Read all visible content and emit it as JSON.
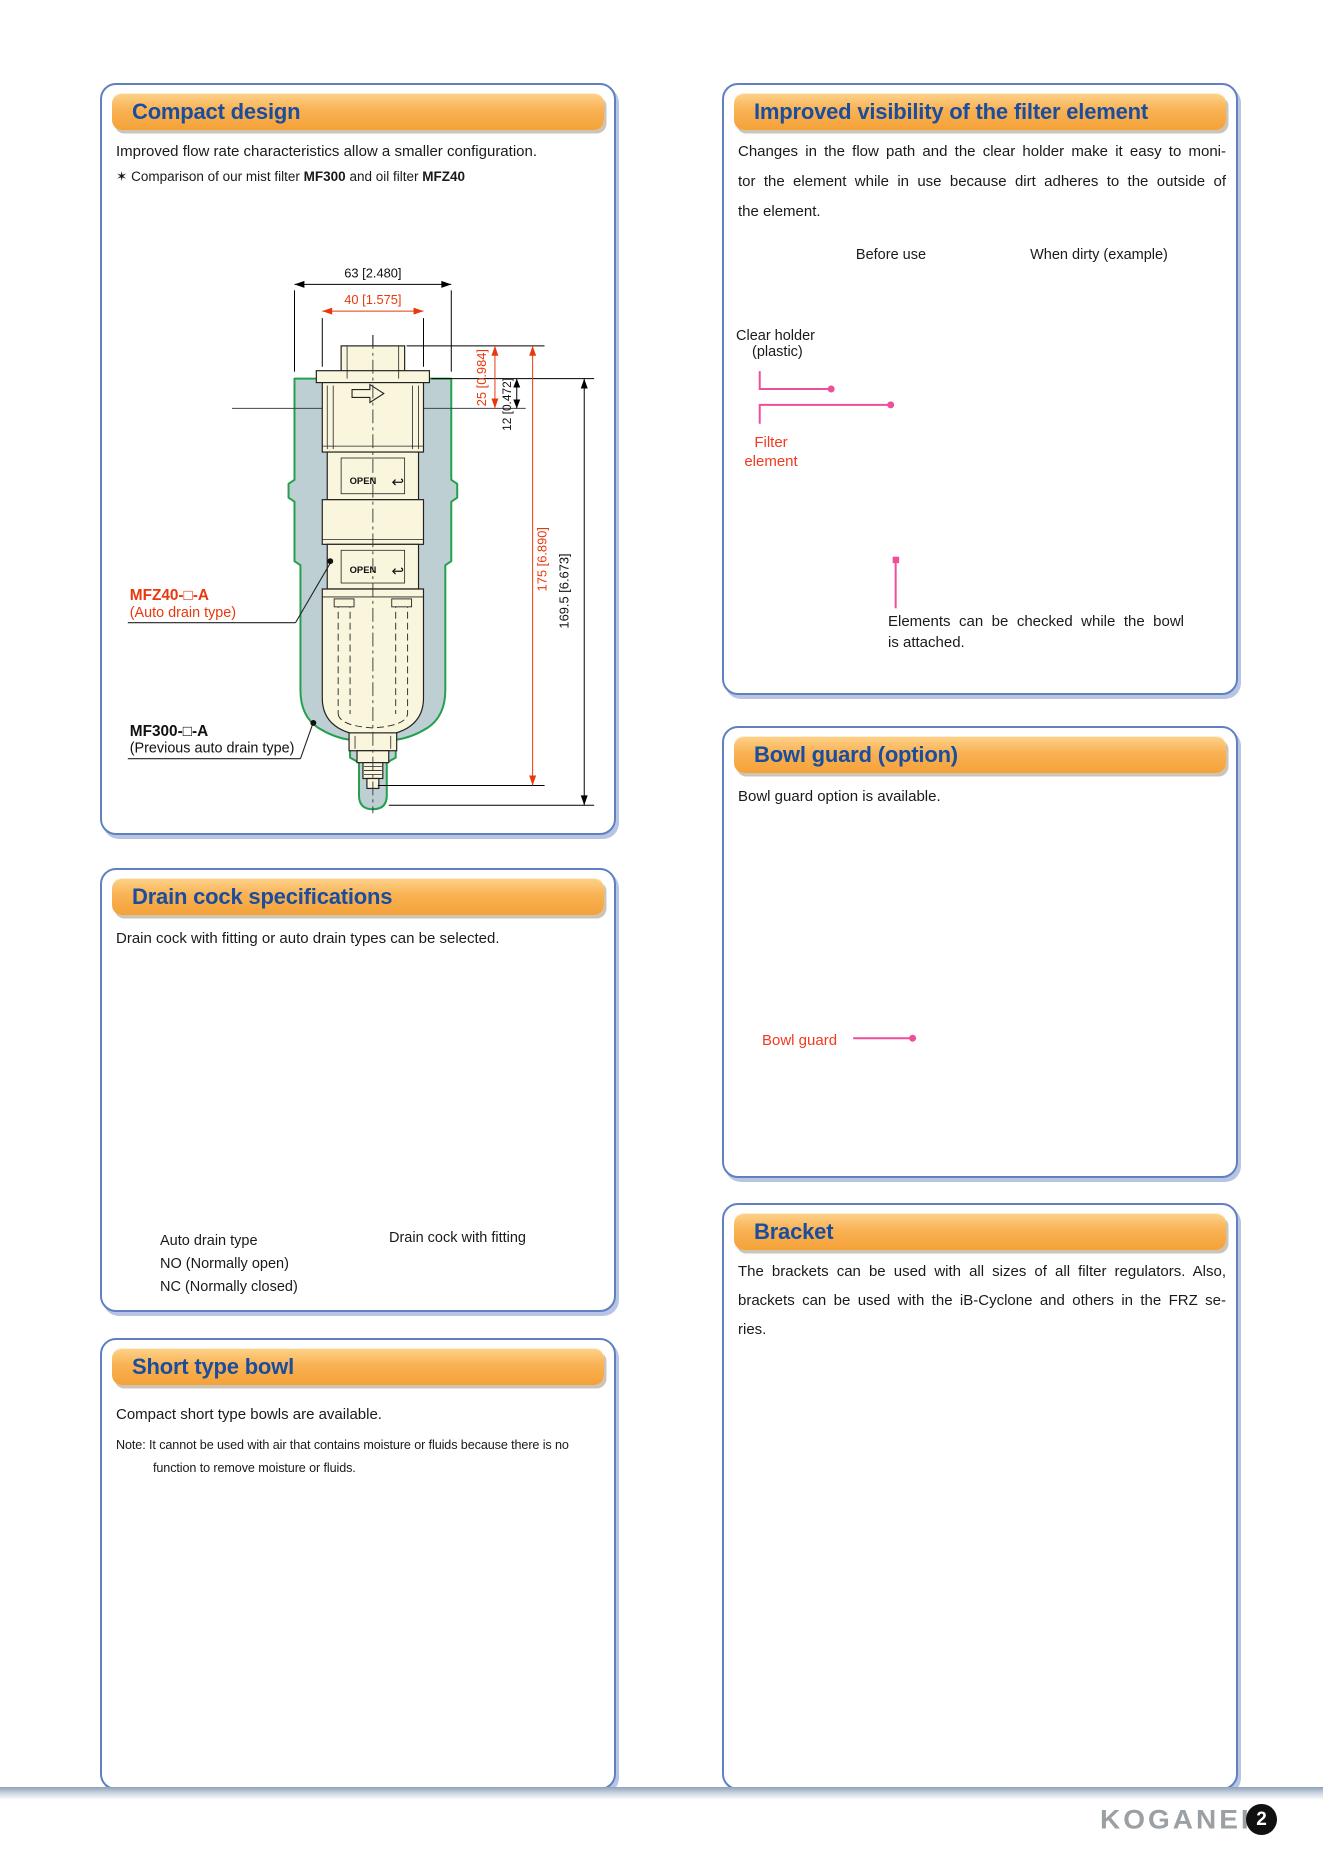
{
  "page": {
    "width": 1323,
    "height": 1871
  },
  "colors": {
    "panel_border": "#6080c2",
    "header_orange": "#f7ab47",
    "title_blue": "#1a4d9e",
    "dimension_red": "#e8380d",
    "label_red": "#f23a20",
    "leader_pink": "#ee4e9a",
    "silhouette_green": "#23a04d",
    "silhouette_fill": "#becfd4",
    "unit_cream": "#faf6dd",
    "logo_gray": "#9ba0a5"
  },
  "panels": {
    "compact_design": {
      "title": "Compact design",
      "intro": "Improved flow rate characteristics allow a smaller configuration.",
      "star": "✶",
      "comparison": {
        "pre": "Comparison of our mist filter",
        "model1": "MF300",
        "mid": "and oil filter",
        "model2": "MFZ40"
      },
      "drawing": {
        "dims": {
          "width_outer": "63 [2.480]",
          "width_inner": "40 [1.575]",
          "height_top": "25 [0.984]",
          "height_port": "12 [0.472]",
          "height_new": "175 [6.890]",
          "height_old": "169.5 [6.673]"
        },
        "open_label": "OPEN",
        "hook": "↩",
        "labels": {
          "new_model": "MFZ40-□-A",
          "new_model_sub": "(Auto drain type)",
          "old_model": "MF300-□-A",
          "old_model_sub": "(Previous auto drain type)"
        }
      }
    },
    "drain_cock": {
      "title": "Drain cock specifications",
      "intro": "Drain cock with fitting or auto drain types can be selected.",
      "captions": {
        "left": [
          "Auto drain type",
          "NO (Normally open)",
          "NC (Normally closed)"
        ],
        "right": "Drain cock with fitting"
      }
    },
    "short_bowl": {
      "title": "Short type bowl",
      "intro": "Compact short type bowls are available.",
      "note_line1": "Note: It cannot be used with air that contains moisture or fluids because there is no",
      "note_line2": "function to remove moisture or fluids."
    },
    "visibility": {
      "title": "Improved visibility of the filter element",
      "para": [
        "Changes in the flow path and the clear holder make it easy to moni-",
        "tor the element while in use because dirt adheres to the outside of",
        "the element."
      ],
      "col_before": "Before use",
      "col_dirty": "When dirty (example)",
      "clear_holder_l1": "Clear holder",
      "clear_holder_l2": "(plastic)",
      "filter_l1": "Filter",
      "filter_l2": "element",
      "caption_l1": "Elements can be checked while the bowl",
      "caption_l2": "is attached."
    },
    "bowl_guard": {
      "title": "Bowl guard (option)",
      "intro": "Bowl guard option is available.",
      "label": "Bowl guard"
    },
    "bracket": {
      "title": "Bracket",
      "para": [
        "The brackets can be used with all sizes of all filter regulators. Also,",
        "brackets can be used with the iB-Cyclone and others in the FRZ se-",
        "ries."
      ]
    }
  },
  "footer": {
    "logo": "KOGANEI",
    "page_number": "2"
  }
}
